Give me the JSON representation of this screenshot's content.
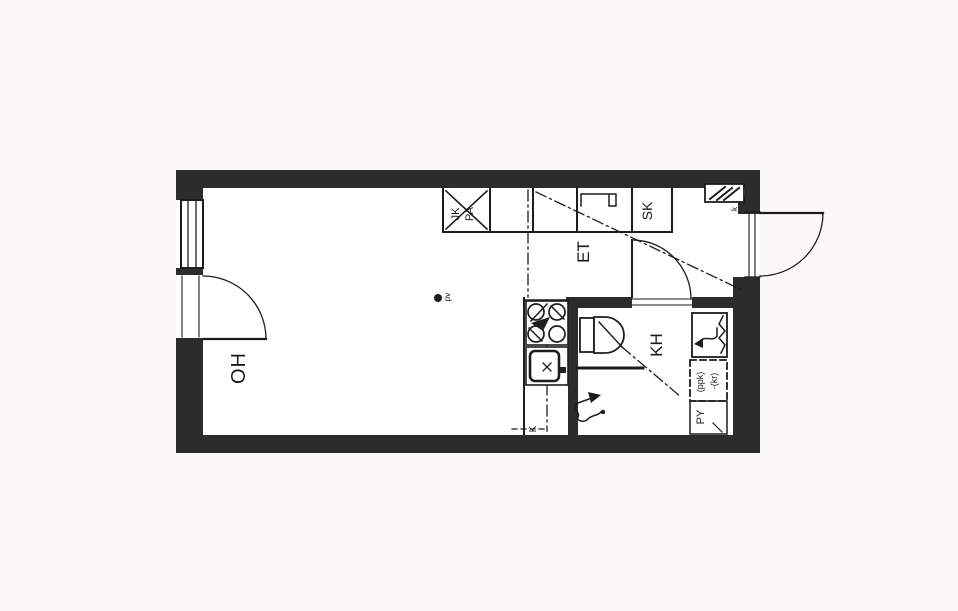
{
  "floorplan": {
    "labels": {
      "living_room": "OH",
      "hallway": "ET",
      "bathroom": "KH",
      "cleaning_closet": "SK",
      "fridge": "JK",
      "freezer": "PA",
      "kitchenette": "K",
      "shaft": "k",
      "column_dot": "pv",
      "washing_machine_reservation": "(ppk)",
      "dryer_reservation": "-(kr)",
      "laundry_cabinet": "PY"
    },
    "colors": {
      "wall": "#2c2c2c",
      "line": "#1d1d1d",
      "text": "#1a1a1a",
      "background": "#faf9f7",
      "floor": "#ffffff"
    }
  }
}
